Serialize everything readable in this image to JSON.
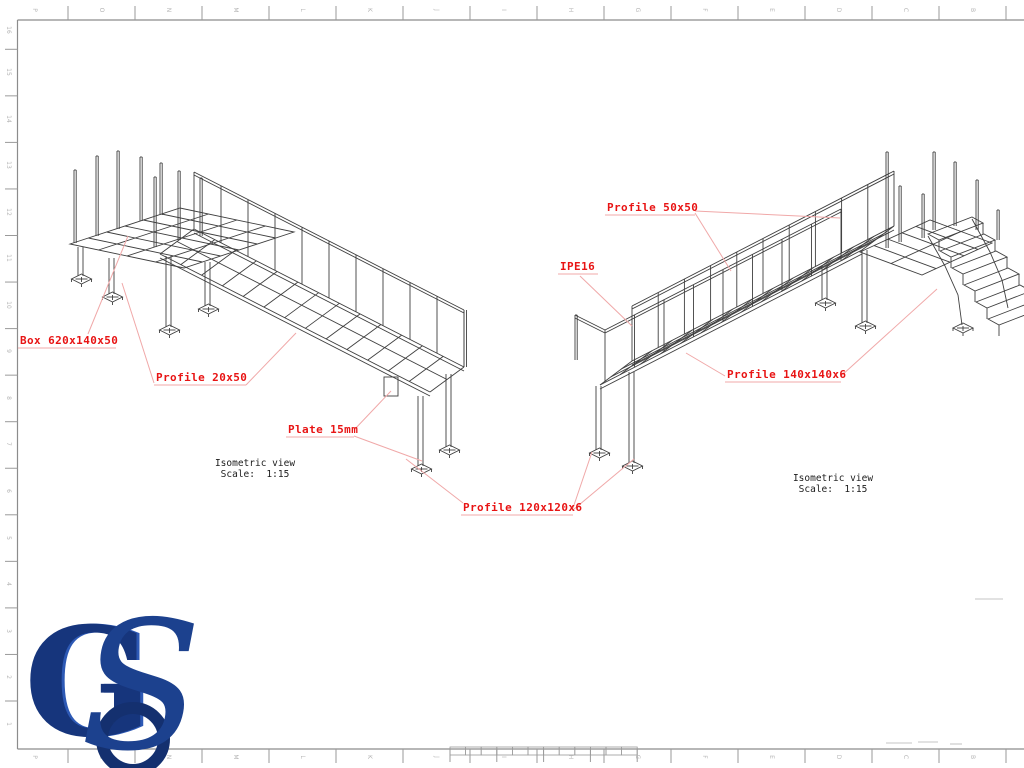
{
  "sheet": {
    "background": "#ffffff",
    "frame_color": "#8c8c8c",
    "line_color": "#3f3f3f",
    "grid_label_color": "#b4b4b4",
    "annotation_text_color": "#e81414",
    "leader_color": "#f0a8a8",
    "caption_color": "#1c1c1c"
  },
  "grid": {
    "top_letters": [
      "P",
      "O",
      "N",
      "M",
      "L",
      "K",
      "J",
      "I",
      "H",
      "G",
      "F",
      "E",
      "D",
      "C",
      "B"
    ],
    "bottom_letters": [
      "P",
      "O",
      "N",
      "M",
      "L",
      "K",
      "J",
      "I",
      "H",
      "G",
      "F",
      "E",
      "D",
      "C",
      "B"
    ],
    "left_numbers": [
      "16",
      "15",
      "14",
      "13",
      "12",
      "11",
      "10",
      "9",
      "8",
      "7",
      "6",
      "5",
      "4",
      "3",
      "2",
      "1"
    ]
  },
  "annotations": [
    {
      "text": "Box 620x140x50",
      "x": 20,
      "y": 334,
      "underline": [
        18,
        348,
        116,
        348
      ],
      "leaders": [
        [
          88,
          334,
          128,
          236
        ]
      ]
    },
    {
      "text": "Profile 20x50",
      "x": 156,
      "y": 371,
      "underline": [
        154,
        385,
        246,
        385
      ],
      "leaders": [
        [
          154,
          383,
          122,
          283
        ],
        [
          246,
          385,
          296,
          333
        ]
      ]
    },
    {
      "text": "Plate 15mm",
      "x": 288,
      "y": 423,
      "underline": [
        286,
        437,
        354,
        437
      ],
      "leaders": [
        [
          354,
          430,
          391,
          391
        ],
        [
          354,
          436,
          422,
          461
        ]
      ]
    },
    {
      "text": "Profile 120x120x6",
      "x": 463,
      "y": 501,
      "underline": [
        461,
        515,
        573,
        515
      ],
      "leaders": [
        [
          463,
          503,
          406,
          459
        ],
        [
          573,
          508,
          592,
          452
        ],
        [
          573,
          510,
          634,
          459
        ]
      ]
    },
    {
      "text": "Profile 50x50",
      "x": 607,
      "y": 201,
      "underline": [
        605,
        215,
        695,
        215
      ],
      "leaders": [
        [
          695,
          213,
          731,
          271
        ],
        [
          695,
          211,
          840,
          218
        ]
      ]
    },
    {
      "text": "IPE16",
      "x": 560,
      "y": 260,
      "underline": [
        558,
        274,
        598,
        274
      ],
      "leaders": [
        [
          580,
          276,
          632,
          326
        ]
      ]
    },
    {
      "text": "Profile 140x140x6",
      "x": 727,
      "y": 368,
      "underline": [
        725,
        382,
        841,
        382
      ],
      "leaders": [
        [
          725,
          376,
          686,
          353
        ],
        [
          841,
          376,
          937,
          289
        ]
      ]
    }
  ],
  "captions": [
    {
      "title": "Isometric view",
      "scale": "Scale:  1:15",
      "cx": 255,
      "y": 458
    },
    {
      "title": "Isometric view",
      "scale": "Scale:  1:15",
      "cx": 833,
      "y": 473
    }
  ],
  "logo": {
    "letter_g": "G",
    "letter_s": "S",
    "color_dark": "#14306f",
    "color_mid": "#1c418e",
    "color_light": "#2d59b5"
  }
}
